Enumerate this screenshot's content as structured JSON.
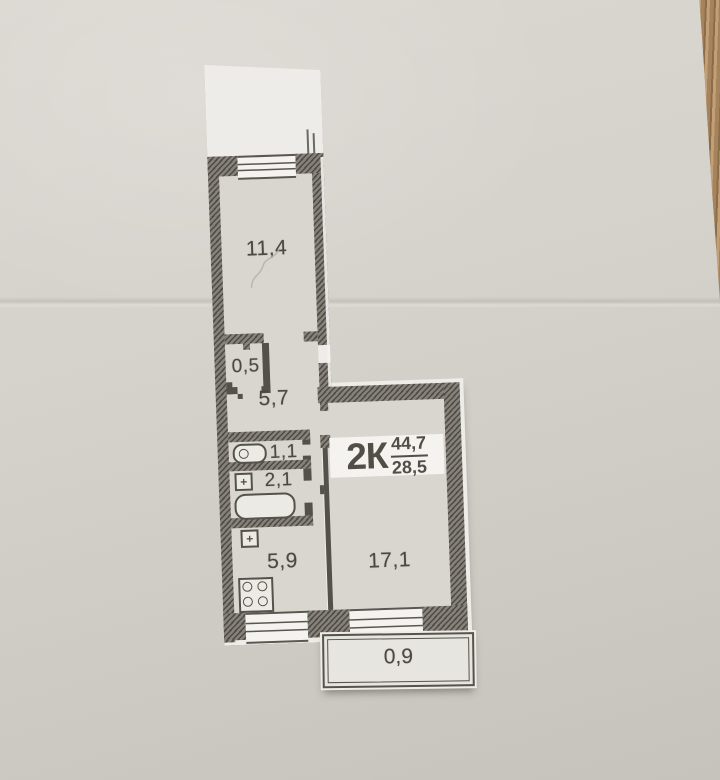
{
  "photo": {
    "background_paper_color": "#d5d1cb",
    "wood_table_color": "#ab8a62",
    "plan_paper_color": "#eeece8",
    "wall_print_color": "#726d65",
    "ink_color": "#4b4843"
  },
  "plan": {
    "apartment_label": {
      "code": "2К",
      "area_total": "44,7",
      "area_living": "28,5"
    },
    "rooms": [
      {
        "name": "room",
        "area": "11,4"
      },
      {
        "name": "built-in-closet",
        "area": "0,5"
      },
      {
        "name": "hallway",
        "area": "5,7"
      },
      {
        "name": "wc",
        "area": "1,1"
      },
      {
        "name": "bathroom",
        "area": "2,1"
      },
      {
        "name": "kitchen",
        "area": "5,9"
      },
      {
        "name": "living-room",
        "area": "17,1"
      },
      {
        "name": "balcony",
        "area": "0,9"
      }
    ],
    "icons": {
      "sink_cross": "+",
      "fixtures": [
        "toilet",
        "wash-sink",
        "bathtub",
        "kitchen-sink",
        "stove-4-burner"
      ],
      "window_symbols": 3
    }
  }
}
